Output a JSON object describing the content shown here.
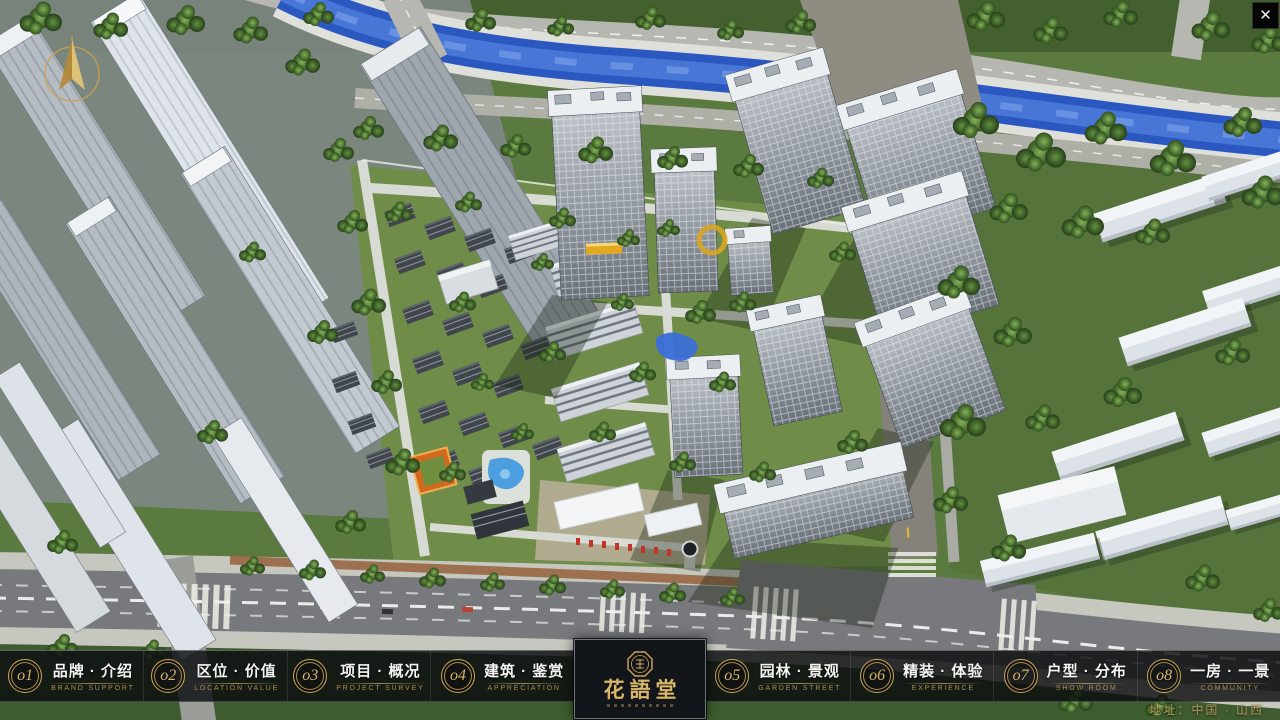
{
  "window": {
    "close": "✕"
  },
  "menu": {
    "items": [
      {
        "num": "o1",
        "title": "品牌 · 介绍",
        "subtitle": "BRAND SUPPORT"
      },
      {
        "num": "o2",
        "title": "区位 · 价值",
        "subtitle": "LOCATION VALUE"
      },
      {
        "num": "o3",
        "title": "项目 · 概况",
        "subtitle": "PROJECT SURVEY"
      },
      {
        "num": "o4",
        "title": "建筑 · 鉴赏",
        "subtitle": "APPRECIATION"
      },
      {
        "num": "o5",
        "title": "园林 · 景观",
        "subtitle": "GARDEN STREET"
      },
      {
        "num": "o6",
        "title": "精装 · 体验",
        "subtitle": "EXPERIENCE"
      },
      {
        "num": "o7",
        "title": "户型 · 分布",
        "subtitle": "SHOW ROOM"
      },
      {
        "num": "o8",
        "title": "一房 · 一景",
        "subtitle": "COMMUNITY"
      }
    ]
  },
  "logo": {
    "title": "花語堂"
  },
  "footer": {
    "address": "地址：中国 · 山西"
  },
  "colors": {
    "gold_accent": "#c9a558",
    "bar_background": "rgba(10,12,15,0.8)",
    "river_blue": "#2b57c0",
    "flag_red": "#c23428"
  }
}
